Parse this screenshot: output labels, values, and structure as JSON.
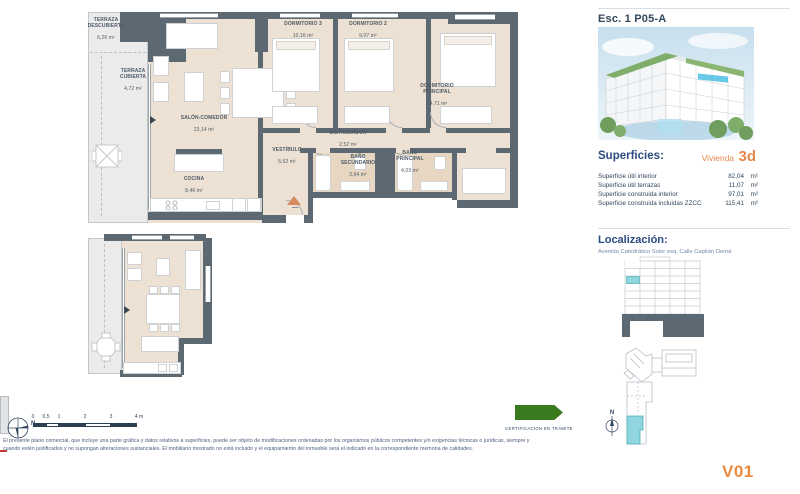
{
  "panel": {
    "title": "Esc. 1 P05-A",
    "north_label": "N",
    "superficies": {
      "heading": "Superficies:",
      "vivienda_label": "Vivienda",
      "vivienda_code": "3d",
      "rows": [
        {
          "label": "Superficie útil interior",
          "value": "82,04",
          "unit": "m²"
        },
        {
          "label": "Superficie útil terrazas",
          "value": "11,07",
          "unit": "m²"
        },
        {
          "label": "Superficie construida interior",
          "value": "97,01",
          "unit": "m²"
        },
        {
          "label": "Superficie construida incluidas ZZCC",
          "value": "115,41",
          "unit": "m²"
        }
      ]
    },
    "localizacion": {
      "heading": "Localización:",
      "address": "Avenida Catedrático Soler esq. Calle Capitán Demá"
    },
    "version": "V01"
  },
  "plan": {
    "rooms": [
      {
        "name": "TERRAZA\nDESCUBIERTA",
        "area": "6,26 m²"
      },
      {
        "name": "TERRAZA\nCUBIERTA",
        "area": "4,72 m²"
      },
      {
        "name": "SALÓN-COMEDOR",
        "area": "23,14 m²"
      },
      {
        "name": "COCINA",
        "area": "8,46 m²"
      },
      {
        "name": "VESTÍBULO",
        "area": "5,52 m²"
      },
      {
        "name": "DISTRIBUIDOR",
        "area": "2,52 m²"
      },
      {
        "name": "BAÑO\nSECUNDARIO",
        "area": "3,94 m²"
      },
      {
        "name": "BAÑO\nPRINCIPAL",
        "area": "4,03 m²"
      },
      {
        "name": "DORMITORIO 3",
        "area": "10,16 m²"
      },
      {
        "name": "DORMITORIO 2",
        "area": "9,07 m²"
      },
      {
        "name": "DORMITORIO\nPRINCIPAL",
        "area": "14,71 m²"
      }
    ]
  },
  "footer": {
    "north_label": "N",
    "scale_ticks": [
      "0",
      "0,5",
      "1",
      "2",
      "3",
      "4 m"
    ],
    "certification": "CERTIFICACIÓN EN TRÁMITE",
    "disclaimer_line1": "El presente plano comercial, que incluye una parte gráfica y datos relativos a superficies, puede ser objeto de modificaciones ordenadas por los organismos públicos competentes y/o exigencias técnicas o jurídicas, siempre y",
    "disclaimer_line2": "cuando estén justificados y no supongan alteraciones sustanciales. El mobiliario mostrado no está incluido y el equipamiento del inmueble será el indicado en la correspondiente memoria de calidades."
  },
  "colors": {
    "accent_orange": "#ed8a3e",
    "heading_blue": "#2b4a80",
    "wall": "#5c6972",
    "floor_beige": "#ece1d3",
    "highlight_cyan": "#8fd6de",
    "certification_green": "#3a7a1e"
  }
}
